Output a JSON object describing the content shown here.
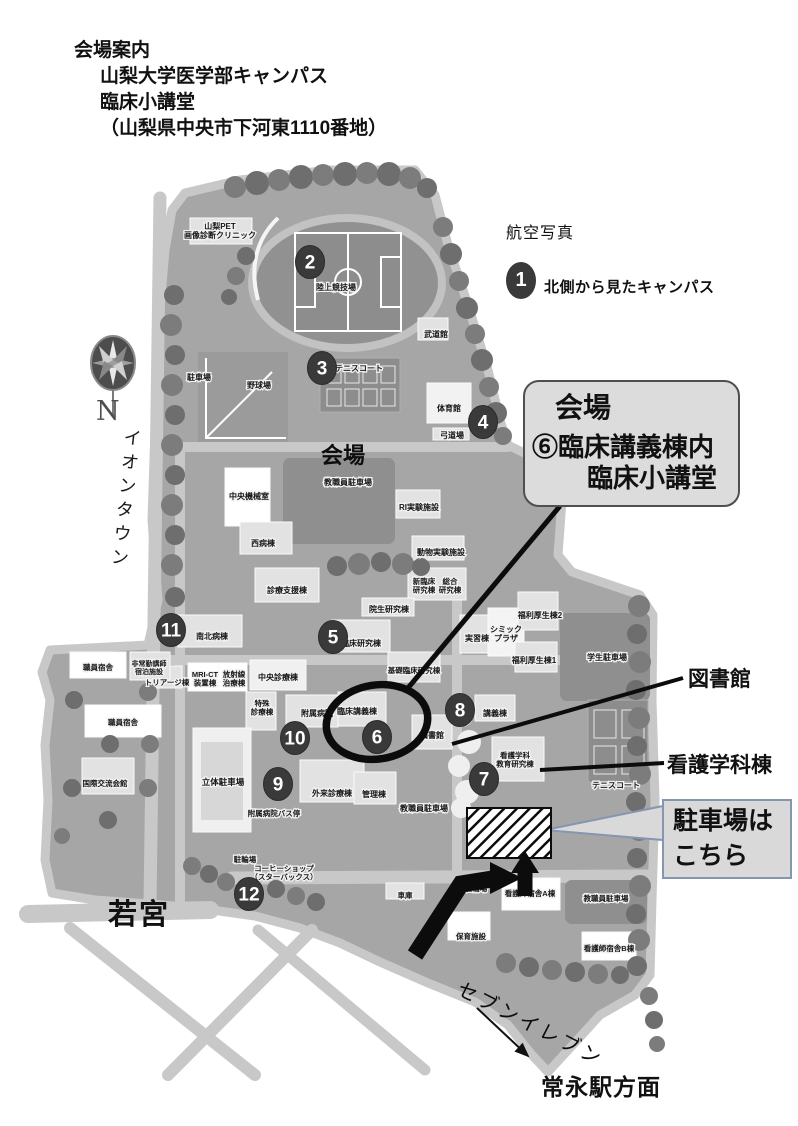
{
  "header": {
    "lines": [
      "会場案内",
      "山梨大学医学部キャンパス",
      "臨床小講堂",
      "（山梨県中央市下河東1110番地）"
    ]
  },
  "legend": {
    "aerial_photo_label": "航空写真",
    "marker_number": "1",
    "marker_text": "北側から見たキャンパス"
  },
  "compass": {
    "north_label": "N"
  },
  "places": {
    "west": "イオンタウン",
    "southwest": "若宮",
    "store": "セブンイレブン",
    "station": "常永駅方面"
  },
  "venue_box": {
    "title": "会場",
    "line1": "⑥臨床講義棟内",
    "line2": "臨床小講堂"
  },
  "callouts": {
    "library": "図書館",
    "nursing_building": "看護学科棟",
    "parking_line1": "駐車場は",
    "parking_line2": "こちら"
  },
  "map": {
    "venue_area_label": "会場",
    "markers": [
      {
        "n": "2",
        "x": 310,
        "y": 262
      },
      {
        "n": "3",
        "x": 322,
        "y": 368
      },
      {
        "n": "4",
        "x": 483,
        "y": 422
      },
      {
        "n": "5",
        "x": 333,
        "y": 637
      },
      {
        "n": "6",
        "x": 377,
        "y": 737
      },
      {
        "n": "7",
        "x": 484,
        "y": 779
      },
      {
        "n": "8",
        "x": 460,
        "y": 710
      },
      {
        "n": "9",
        "x": 278,
        "y": 784
      },
      {
        "n": "10",
        "x": 295,
        "y": 738
      },
      {
        "n": "11",
        "x": 171,
        "y": 630
      },
      {
        "n": "12",
        "x": 249,
        "y": 894
      }
    ],
    "building_labels": [
      {
        "t": "山梨PET\n画像診断クリニック",
        "x": 220,
        "y": 229,
        "s": 8
      },
      {
        "t": "陸上競技場",
        "x": 336,
        "y": 290,
        "s": 8
      },
      {
        "t": "駐車場",
        "x": 199,
        "y": 380,
        "s": 8
      },
      {
        "t": "野球場",
        "x": 259,
        "y": 388,
        "s": 8
      },
      {
        "t": "テニスコート",
        "x": 359,
        "y": 371,
        "s": 8
      },
      {
        "t": "武道館",
        "x": 436,
        "y": 337,
        "s": 8
      },
      {
        "t": "体育館",
        "x": 449,
        "y": 411,
        "s": 8
      },
      {
        "t": "弓道場",
        "x": 452,
        "y": 438,
        "s": 8
      },
      {
        "t": "教職員駐車場",
        "x": 348,
        "y": 485,
        "s": 8
      },
      {
        "t": "中央機械室",
        "x": 249,
        "y": 499,
        "s": 8
      },
      {
        "t": "RI実験施設",
        "x": 419,
        "y": 510,
        "s": 8
      },
      {
        "t": "西病棟",
        "x": 263,
        "y": 546,
        "s": 8
      },
      {
        "t": "動物実験施設",
        "x": 441,
        "y": 555,
        "s": 8
      },
      {
        "t": "診療支援棟",
        "x": 287,
        "y": 593,
        "s": 8
      },
      {
        "t": "新臨床\n研究棟",
        "x": 424,
        "y": 584,
        "s": 7.5
      },
      {
        "t": "総合\n研究棟",
        "x": 450,
        "y": 584,
        "s": 7.5
      },
      {
        "t": "院生研究棟",
        "x": 389,
        "y": 612,
        "s": 8
      },
      {
        "t": "福利厚生棟2",
        "x": 540,
        "y": 618,
        "s": 8
      },
      {
        "t": "シミック\nプラザ",
        "x": 506,
        "y": 632,
        "s": 8
      },
      {
        "t": "実習棟",
        "x": 477,
        "y": 641,
        "s": 8
      },
      {
        "t": "南北病棟",
        "x": 212,
        "y": 639,
        "s": 8
      },
      {
        "t": "臨床研究棟",
        "x": 361,
        "y": 646,
        "s": 8
      },
      {
        "t": "学生駐車場",
        "x": 607,
        "y": 660,
        "s": 8
      },
      {
        "t": "福利厚生棟1",
        "x": 534,
        "y": 663,
        "s": 8
      },
      {
        "t": "トリアージ棟",
        "x": 167,
        "y": 685,
        "s": 7.5
      },
      {
        "t": "MRI-CT\n装置棟",
        "x": 205,
        "y": 677,
        "s": 7.5
      },
      {
        "t": "放射線\n治療棟",
        "x": 234,
        "y": 677,
        "s": 7.5
      },
      {
        "t": "中央診療棟",
        "x": 278,
        "y": 680,
        "s": 8
      },
      {
        "t": "特殊\n診療棟",
        "x": 262,
        "y": 706,
        "s": 7.5
      },
      {
        "t": "附属病院",
        "x": 317,
        "y": 716,
        "s": 8
      },
      {
        "t": "基礎臨床研究棟",
        "x": 414,
        "y": 673,
        "s": 7.5
      },
      {
        "t": "臨床講義棟",
        "x": 357,
        "y": 714,
        "s": 8
      },
      {
        "t": "図書館",
        "x": 432,
        "y": 738,
        "s": 8
      },
      {
        "t": "講義棟",
        "x": 495,
        "y": 716,
        "s": 8
      },
      {
        "t": "看護学科\n教育研究棟",
        "x": 515,
        "y": 758,
        "s": 7.5
      },
      {
        "t": "立体駐車場",
        "x": 223,
        "y": 785,
        "s": 8.5
      },
      {
        "t": "外来診療棟",
        "x": 332,
        "y": 796,
        "s": 8
      },
      {
        "t": "管理棟",
        "x": 374,
        "y": 797,
        "s": 8
      },
      {
        "t": "教職員駐車場",
        "x": 424,
        "y": 811,
        "s": 8
      },
      {
        "t": "附属病院バス停",
        "x": 274,
        "y": 816,
        "s": 7.5
      },
      {
        "t": "テニスコート",
        "x": 616,
        "y": 788,
        "s": 8
      },
      {
        "t": "駐輪場",
        "x": 245,
        "y": 862,
        "s": 7.5
      },
      {
        "t": "コーヒーショップ\n（スターバックス）",
        "x": 284,
        "y": 871,
        "s": 7.5
      },
      {
        "t": "車庫",
        "x": 405,
        "y": 898,
        "s": 7.5
      },
      {
        "t": "駐輪場",
        "x": 476,
        "y": 891,
        "s": 7.5
      },
      {
        "t": "看護師宿舎A棟",
        "x": 530,
        "y": 896,
        "s": 7.5
      },
      {
        "t": "教職員駐車場",
        "x": 606,
        "y": 901,
        "s": 7.5
      },
      {
        "t": "保育施設",
        "x": 471,
        "y": 939,
        "s": 7.5
      },
      {
        "t": "看護師宿舎B棟",
        "x": 609,
        "y": 951,
        "s": 7.5
      },
      {
        "t": "職員宿舎",
        "x": 98,
        "y": 670,
        "s": 7.5
      },
      {
        "t": "非常勤講師\n宿泊施設",
        "x": 149,
        "y": 666,
        "s": 7
      },
      {
        "t": "職員宿舎",
        "x": 123,
        "y": 725,
        "s": 7.5
      },
      {
        "t": "国際交流会館",
        "x": 105,
        "y": 786,
        "s": 7.5
      }
    ]
  },
  "colors": {
    "ground": "#a6a6a6",
    "road": "#c8c8c8",
    "building": "#e2e2e2",
    "tree": "#6e6e6e",
    "white_tree": "#efefef",
    "marker": "#3a3a3a",
    "parking_lot": "#8f8f8f",
    "venue_box_bg": "#dcdcdc",
    "venue_box_border": "#4f4f4f",
    "parking_box_border": "#8496b0"
  }
}
